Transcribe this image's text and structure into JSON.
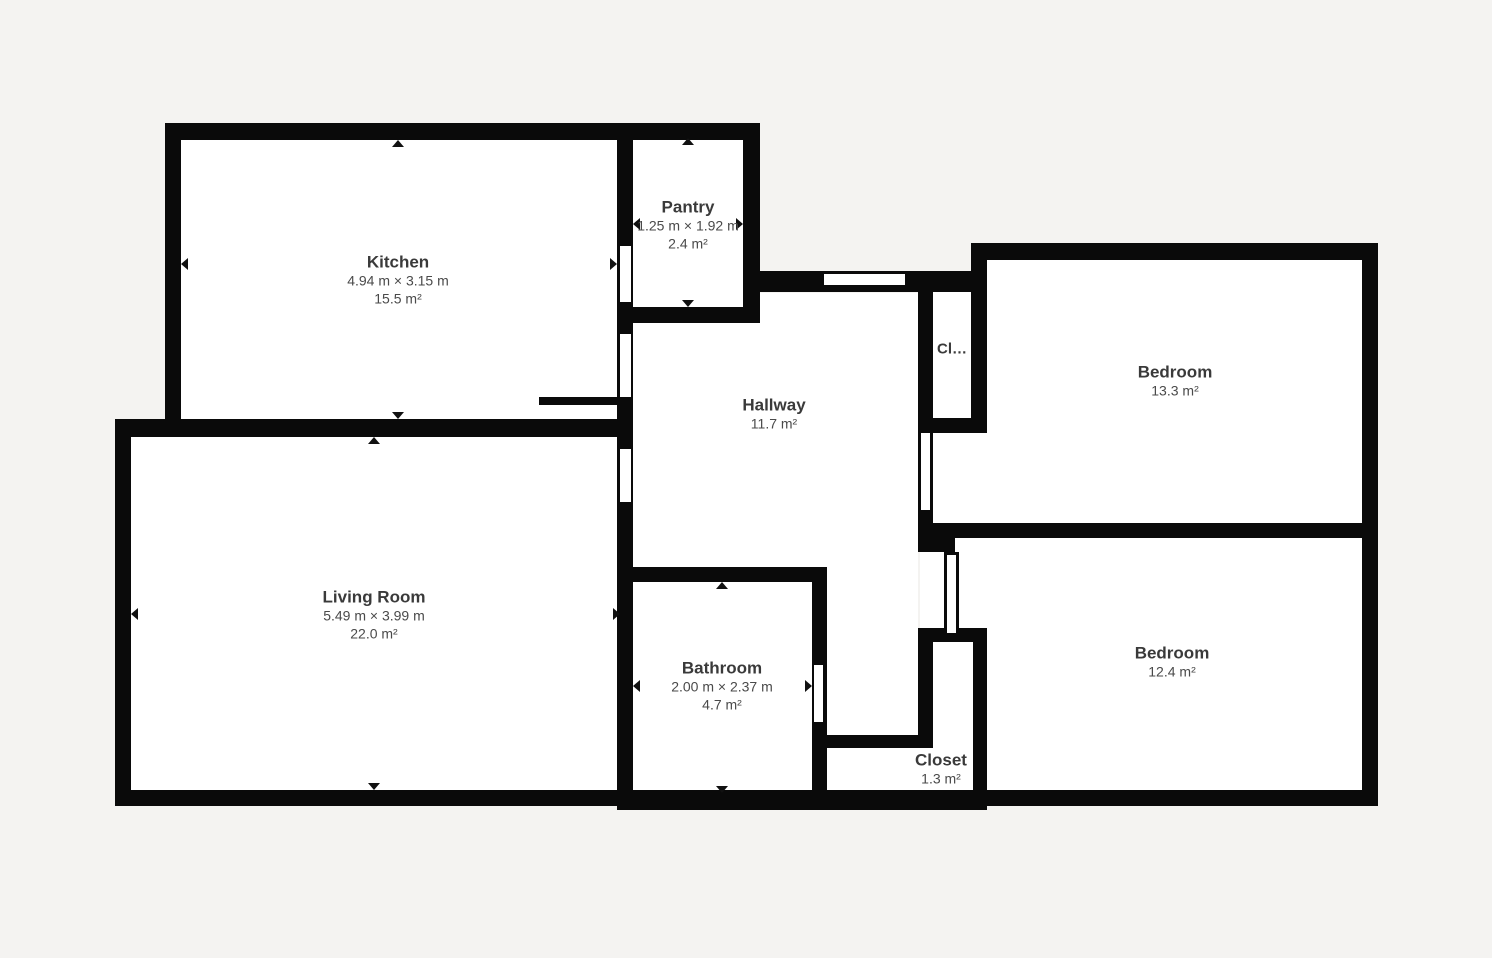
{
  "colors": {
    "background": "#f4f3f1",
    "wall": "#0a0a0a",
    "floor": "#ffffff",
    "room_name_text": "#3a3a3a",
    "dimension_text": "#4a4a4a"
  },
  "icons": {
    "dim_arrow_up": "black triangle pointing up",
    "dim_arrow_down": "black triangle pointing down",
    "dim_arrow_left": "black triangle pointing left",
    "dim_arrow_right": "black triangle pointing right"
  },
  "rooms": [
    {
      "id": "kitchen",
      "name": "Kitchen",
      "dimensions": "4.94 m × 3.15 m",
      "area": "15.5 m²"
    },
    {
      "id": "pantry",
      "name": "Pantry",
      "dimensions": "1.25 m × 1.92 m",
      "area": "2.4 m²"
    },
    {
      "id": "hallway",
      "name": "Hallway",
      "area": "11.7 m²"
    },
    {
      "id": "closet-small",
      "name": "Cl…"
    },
    {
      "id": "bedroom-1",
      "name": "Bedroom",
      "area": "13.3 m²"
    },
    {
      "id": "bedroom-2",
      "name": "Bedroom",
      "area": "12.4 m²"
    },
    {
      "id": "living-room",
      "name": "Living Room",
      "dimensions": "5.49 m × 3.99 m",
      "area": "22.0 m²"
    },
    {
      "id": "bathroom",
      "name": "Bathroom",
      "dimensions": "2.00 m × 2.37 m",
      "area": "4.7 m²"
    },
    {
      "id": "closet",
      "name": "Closet",
      "area": "1.3 m²"
    }
  ]
}
